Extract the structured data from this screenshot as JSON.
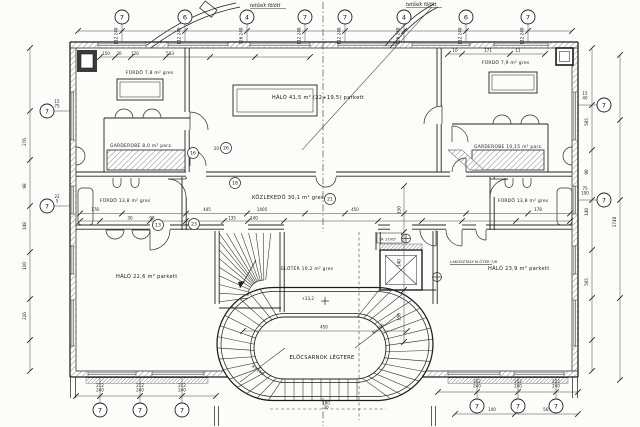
{
  "rooms": {
    "furdo_top_left": "FÜRDŐ 7,8 m² gres",
    "garderobe_left": "GARDEROBE 8,0 m² parz.",
    "halo_top": "HÁLÓ 41,5 m² (22+19,5) parkett",
    "furdo_top_right": "FÜRDŐ 7,9 m² gres",
    "garderobe_right": "GARDEROBE 10,15 m² parz.",
    "furdo_mid_left": "FÜRDŐ 13,8 m² gres",
    "furdo_mid_right": "FÜRDŐ 13,8 m² gres",
    "kozlekedo": "KÖZLEKEDŐ 30,1 m² gres",
    "eloter": "ELŐTÉR 10,2 m² gres",
    "halo_bottom_left": "HÁLÓ 22,6 m² parkett",
    "halo_bottom_right": "HÁLÓ 23,9 m² parkett",
    "elocsarnok": "ELŐCSARNOK LÉGTERE",
    "suite_note": "LAKOSZTÁLY ELŐTÉR 7/6",
    "lift_tag": "TA 17/05",
    "roof_note_left": "tetősík fölött",
    "roof_note_right": "tetősík fölött"
  },
  "grid": {
    "top": [
      "7",
      "6",
      "4",
      "7",
      "7",
      "4",
      "6",
      "7"
    ],
    "left": [
      "7",
      "7"
    ],
    "right": [
      "7",
      "7"
    ],
    "bottom_left": [
      "7",
      "7",
      "7"
    ],
    "bottom_right": [
      "7",
      "7",
      "7"
    ]
  },
  "room_circles": [
    "16",
    "26",
    "13",
    "23",
    "21",
    "18"
  ],
  "dims": {
    "top_inner": [
      "150",
      "30",
      "120",
      "583"
    ],
    "right_top": [
      "10",
      "171",
      "11"
    ],
    "top_stems": [
      "112/240",
      "112/240",
      "126/240",
      "112/240",
      "112/240",
      "126/240",
      "112/240",
      "112/240"
    ],
    "left_outer": [
      "276",
      "98",
      "148",
      "110",
      "226"
    ],
    "left_leaders": [
      "15/75",
      "22/5"
    ],
    "right_outer": [
      "585",
      "90",
      "140",
      "565"
    ],
    "right_leaders": [
      "15/40",
      "75/100"
    ],
    "right_far": "1740",
    "corridor_row1": [
      "178",
      "445",
      "1405",
      "450",
      "178"
    ],
    "corridor_row2": [
      "30",
      "98",
      "135",
      "140"
    ],
    "mid_vertical": [
      "150",
      "140",
      "150"
    ],
    "oval_width": "450",
    "radius_left": "R=150",
    "radius_right": "R=150",
    "level_mark": "+13,2",
    "under_oval": [
      "180",
      "30"
    ],
    "bottom_left_stems": [
      "212/240",
      "212/240",
      "212/240"
    ],
    "bottom_right_stems": [
      "212/240",
      "212/240",
      "212/240"
    ],
    "bottom_right_chain": [
      "140",
      "565"
    ],
    "circle_prefix": "20"
  }
}
